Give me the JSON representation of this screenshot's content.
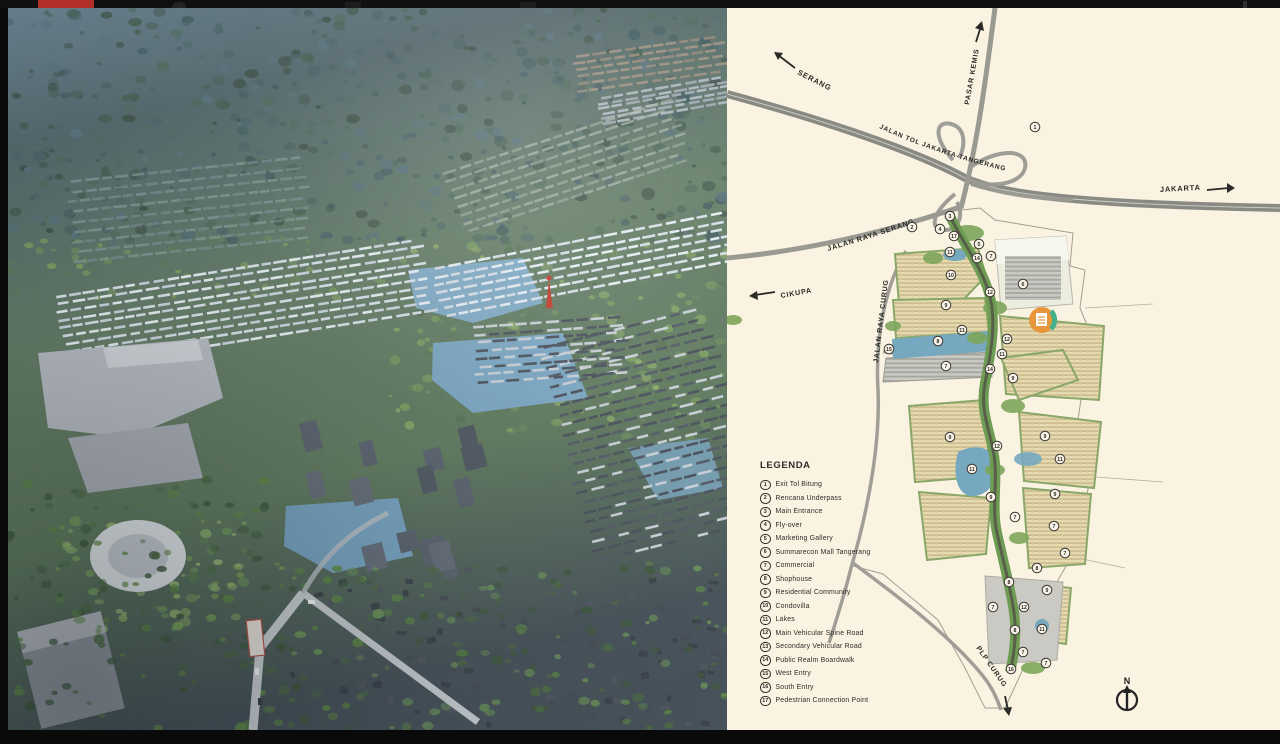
{
  "legend": {
    "title": "LEGENDA",
    "items": [
      {
        "num": "1",
        "label": "Exit Tol Bitung"
      },
      {
        "num": "2",
        "label": "Rencana Underpass"
      },
      {
        "num": "3",
        "label": "Main Entrance"
      },
      {
        "num": "4",
        "label": "Fly-over"
      },
      {
        "num": "5",
        "label": "Marketing Gallery"
      },
      {
        "num": "6",
        "label": "Summarecon Mall Tangerang"
      },
      {
        "num": "7",
        "label": "Commercial"
      },
      {
        "num": "8",
        "label": "Shophouse"
      },
      {
        "num": "9",
        "label": "Residential Community"
      },
      {
        "num": "10",
        "label": "Condovilla"
      },
      {
        "num": "11",
        "label": "Lakes"
      },
      {
        "num": "12",
        "label": "Main Vehicular Spine Road"
      },
      {
        "num": "13",
        "label": "Secondary Vehicular Road"
      },
      {
        "num": "14",
        "label": "Public Realm Boardwalk"
      },
      {
        "num": "15",
        "label": "West Entry"
      },
      {
        "num": "16",
        "label": "South Entry"
      },
      {
        "num": "17",
        "label": "Pedestrian Connection Point"
      }
    ]
  },
  "map": {
    "compass_label": "N",
    "road_labels": {
      "serang": "SERANG",
      "pasar_kemis": "PASAR KEMIS",
      "jakarta": "JAKARTA",
      "toll": "JALAN TOL JAKARTA-TANGERANG",
      "jalan_raya_serang": "JALAN RAYA SERANG",
      "cikupa": "CIKUPA",
      "jalan_raya_curug": "JALAN RAYA CURUG",
      "plp_curug": "PLP CURUG"
    },
    "markers": [
      {
        "n": "1",
        "x": 302,
        "y": 119
      },
      {
        "n": "2",
        "x": 179,
        "y": 219
      },
      {
        "n": "3",
        "x": 217,
        "y": 208
      },
      {
        "n": "4",
        "x": 207,
        "y": 221
      },
      {
        "n": "17",
        "x": 221,
        "y": 228
      },
      {
        "n": "5",
        "x": 246,
        "y": 236
      },
      {
        "n": "11",
        "x": 217,
        "y": 244
      },
      {
        "n": "7",
        "x": 258,
        "y": 248
      },
      {
        "n": "14",
        "x": 244,
        "y": 250
      },
      {
        "n": "10",
        "x": 218,
        "y": 267
      },
      {
        "n": "6",
        "x": 290,
        "y": 276
      },
      {
        "n": "12",
        "x": 257,
        "y": 284
      },
      {
        "n": "9",
        "x": 213,
        "y": 297
      },
      {
        "n": "11",
        "x": 229,
        "y": 322
      },
      {
        "n": "12",
        "x": 274,
        "y": 331
      },
      {
        "n": "8",
        "x": 205,
        "y": 333
      },
      {
        "n": "15",
        "x": 156,
        "y": 341
      },
      {
        "n": "11",
        "x": 269,
        "y": 346
      },
      {
        "n": "7",
        "x": 213,
        "y": 358
      },
      {
        "n": "14",
        "x": 257,
        "y": 361
      },
      {
        "n": "9",
        "x": 280,
        "y": 370
      },
      {
        "n": "9",
        "x": 217,
        "y": 429
      },
      {
        "n": "9",
        "x": 312,
        "y": 428
      },
      {
        "n": "12",
        "x": 264,
        "y": 438
      },
      {
        "n": "11",
        "x": 239,
        "y": 461
      },
      {
        "n": "11",
        "x": 327,
        "y": 451
      },
      {
        "n": "9",
        "x": 258,
        "y": 489
      },
      {
        "n": "9",
        "x": 322,
        "y": 486
      },
      {
        "n": "7",
        "x": 282,
        "y": 509
      },
      {
        "n": "7",
        "x": 321,
        "y": 518
      },
      {
        "n": "7",
        "x": 332,
        "y": 545
      },
      {
        "n": "8",
        "x": 304,
        "y": 560
      },
      {
        "n": "8",
        "x": 276,
        "y": 574
      },
      {
        "n": "9",
        "x": 314,
        "y": 582
      },
      {
        "n": "7",
        "x": 260,
        "y": 599
      },
      {
        "n": "12",
        "x": 291,
        "y": 599
      },
      {
        "n": "8",
        "x": 282,
        "y": 622
      },
      {
        "n": "11",
        "x": 309,
        "y": 621
      },
      {
        "n": "7",
        "x": 290,
        "y": 644
      },
      {
        "n": "7",
        "x": 313,
        "y": 655
      },
      {
        "n": "16",
        "x": 278,
        "y": 661
      }
    ],
    "colors": {
      "background": "#faf3e2",
      "road_gray": "#9a9a93",
      "spine_green": "#6f9c55",
      "water_blue": "#76a8c0",
      "residential_beige": "#e7dbb2",
      "badge_orange": "#e8963c",
      "badge_teal": "#45b08c"
    }
  }
}
